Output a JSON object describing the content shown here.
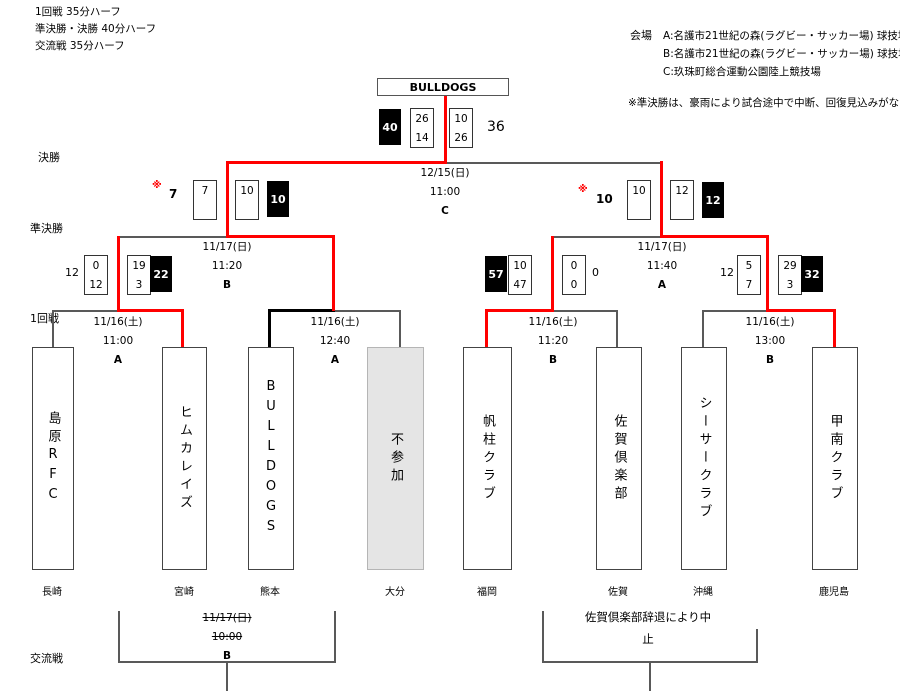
{
  "meta": {
    "rules": [
      "1回戦  35分ハーフ",
      "準決勝・決勝  40分ハーフ",
      "交流戦  35分ハーフ"
    ],
    "venues_label": "会場",
    "venues": [
      "A:名護市21世紀の森(ラグビー・サッカー場) 球技場",
      "B:名護市21世紀の森(ラグビー・サッカー場) 球技場",
      "C:玖珠町総合運動公園陸上競技場"
    ],
    "note": "※準決勝は、豪雨により試合途中で中断、回復見込みがないため大会"
  },
  "round_labels": {
    "final": "決勝",
    "semifinal": "準決勝",
    "first": "1回戦",
    "exchange": "交流戦"
  },
  "champion": "BULLDOGS",
  "final_match": {
    "date": "12/15(日)",
    "time": "11:00",
    "venue": "C",
    "winner_total": "40",
    "winner_halves": [
      "26",
      "14"
    ],
    "loser_halves": [
      "10",
      "26"
    ],
    "loser_total": "36"
  },
  "semifinals": [
    {
      "mark": "※",
      "loser_total": "7",
      "loser_halves": [
        "7",
        ""
      ],
      "winner_halves": [
        "10",
        ""
      ],
      "winner_total": "10",
      "date": "11/17(日)",
      "time": "11:20",
      "venue": "B"
    },
    {
      "mark": "※",
      "loser_total": "10",
      "loser_halves": [
        "10",
        ""
      ],
      "winner_halves": [
        "12",
        ""
      ],
      "winner_total": "12",
      "date": "11/17(日)",
      "time": "11:40",
      "venue": "A"
    }
  ],
  "first_round": [
    {
      "date": "11/16(土)",
      "time": "11:00",
      "venue": "A",
      "loser_total": "12",
      "loser_halves": [
        "0",
        "12"
      ],
      "winner_halves": [
        "19",
        "3"
      ],
      "winner_total": "22"
    },
    {
      "date": "11/16(土)",
      "time": "12:40",
      "venue": "A"
    },
    {
      "date": "11/16(土)",
      "time": "11:20",
      "venue": "B",
      "winner_total": "57",
      "winner_halves": [
        "10",
        "47"
      ],
      "loser_halves": [
        "0",
        "0"
      ],
      "loser_total": "0"
    },
    {
      "date": "11/16(土)",
      "time": "13:00",
      "venue": "B",
      "loser_total": "12",
      "loser_halves": [
        "5",
        "7"
      ],
      "winner_halves": [
        "29",
        "3"
      ],
      "winner_total": "32"
    }
  ],
  "teams": [
    {
      "name": "島原RFC",
      "pref": "長崎"
    },
    {
      "name": "ヒムカレイズ",
      "pref": "宮崎"
    },
    {
      "name": "BULLDOGS",
      "pref": "熊本"
    },
    {
      "name": "不参加",
      "pref": "大分"
    },
    {
      "name": "帆柱クラブ",
      "pref": "福岡"
    },
    {
      "name": "佐賀倶楽部",
      "pref": "佐賀"
    },
    {
      "name": "シーサークラブ",
      "pref": "沖縄"
    },
    {
      "name": "甲南クラブ",
      "pref": "鹿児島"
    }
  ],
  "exchange": {
    "left": {
      "date": "11/17(日)",
      "time": "10:00",
      "venue": "B"
    },
    "right": {
      "note_line1": "佐賀倶楽部辞退により中",
      "note_line2": "止"
    }
  },
  "colors": {
    "path_red": "#FF0000",
    "line_gray": "#595959",
    "walkover_black": "#000000",
    "absent_fill": "#E5E5E5"
  }
}
